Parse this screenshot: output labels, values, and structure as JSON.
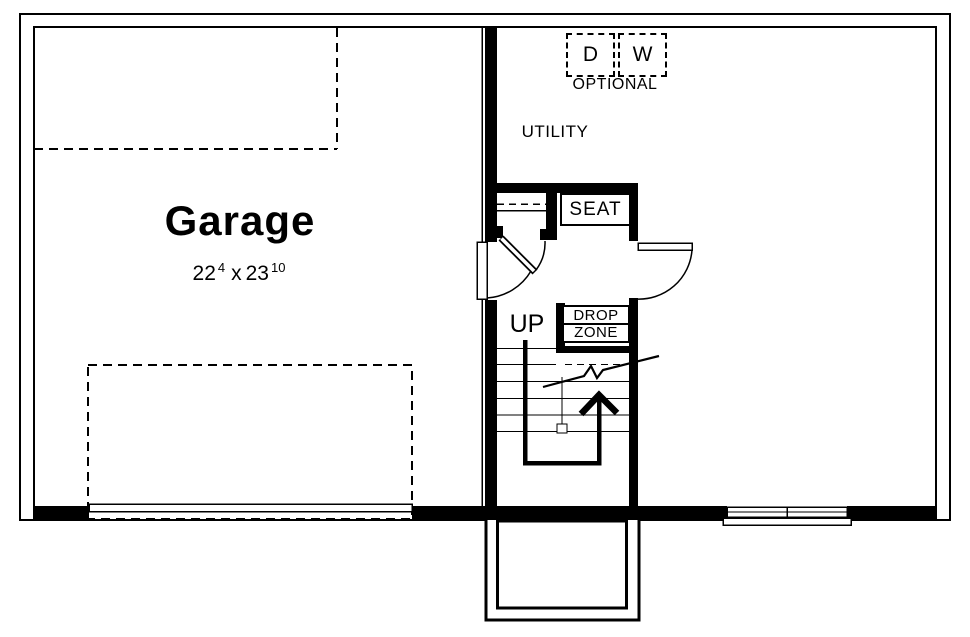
{
  "plan": {
    "garage": {
      "name": "Garage",
      "dimensions": {
        "width_ft": "22",
        "width_in": "4",
        "separator": "x",
        "depth_ft": "23",
        "depth_in": "10"
      }
    },
    "utility": {
      "name": "UTILITY"
    },
    "appliances": {
      "dryer": "D",
      "washer": "W",
      "note": "OPTIONAL"
    },
    "mudroom": {
      "seat": "SEAT",
      "drop_zone_line1": "DROP",
      "drop_zone_line2": "ZONE"
    },
    "stairs": {
      "direction": "UP"
    }
  },
  "colors": {
    "ink": "#000000",
    "paper": "#ffffff"
  }
}
